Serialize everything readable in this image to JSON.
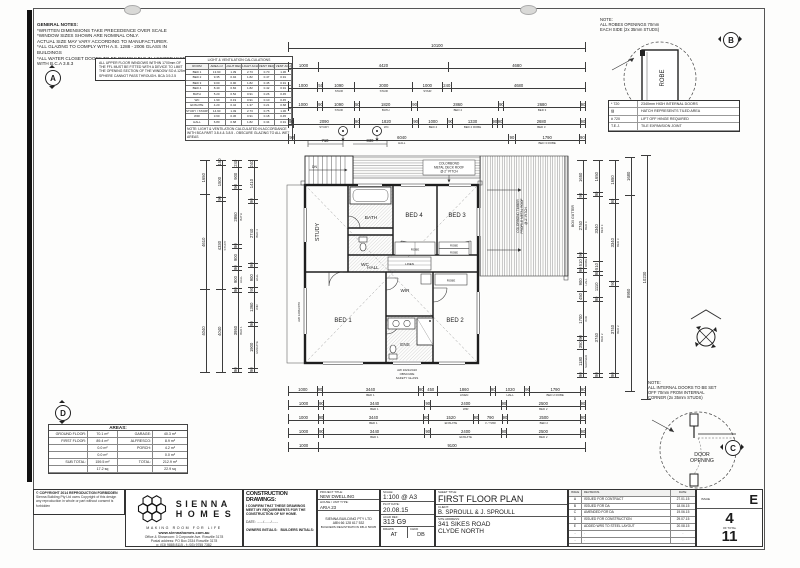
{
  "general_notes": {
    "title": "GENERAL NOTES:",
    "lines": [
      "*WRITTEN DIMENSIONS TAKE PRECEDENCE OVER SCALE",
      "*WINDOW SIZES SHOWN ARE NOMINAL ONLY.",
      "ACTUAL SIZE MAY VARY ACCORDING TO MANUFACTURER.",
      "*ALL GLAZING TO COMPLY WITH A.S. 1288 - 2006 GLASS IN",
      "BUILDINGS",
      "*ALL WATER CLOSET DOORS TO BE REMOVABLE IN ACCORDANCE",
      "WITH B.C.A 3.8.3"
    ]
  },
  "note_a": {
    "letter": "A",
    "lines": [
      "ALL UPPER FLOOR WINDOWS WITHIN 1700mm OF",
      "THE FFL MUST BE FITTED WITH A DEVICE TO LIMIT",
      "THE OPENING SECTION OF THE WINDOW SO A 125mm",
      "SPHERE CANNOT PASS THROUGH- BCA 3.9.2.5"
    ]
  },
  "note_b": {
    "letter": "B",
    "lines": [
      "NOTE:",
      "ALL ROBES OPENINGS 70mm",
      "EACH SIDE (2x 35mm STUDS)"
    ],
    "robe": "ROBE"
  },
  "note_c": {
    "letter": "C",
    "lines": [
      "NOTE:",
      "ALL INTERNAL DOORS TO BE SET",
      "OFF 70mm FROM INTERNAL",
      "CORNER (2x 35mm STUDS)"
    ],
    "label1": "DOOR",
    "label2": "OPENING"
  },
  "marker_d": "D",
  "legend": {
    "rows": [
      {
        "k": "* 720",
        "d": "2340mm HIGH INTERNAL DOORS"
      },
      {
        "k": "▨",
        "d": "HATCH REPRESENTS TILED AREA"
      },
      {
        "k": "# 720",
        "d": "LIFT OFF HINGE REQUIRED"
      },
      {
        "k": "T.E.J.",
        "d": "TILE EXPANSION JOINT"
      }
    ]
  },
  "vent_table": {
    "title": "LIGHT & VENTILATION CALCULATIONS",
    "headers": {
      "c0": "ROOM",
      "c1": "AREA m²",
      "c2": "LIGHT REQ",
      "c3": "LIGHT ACH",
      "c4": "VENT REQ",
      "c5": "VENT ACH"
    },
    "rows": [
      {
        "c0": "BED 1",
        "c1": "13.90",
        "c2": "1.39",
        "c3": "2.73",
        "c4": "0.70",
        "c5": "1.36"
      },
      {
        "c0": "BED 2",
        "c1": "9.35",
        "c2": "0.94",
        "c3": "1.82",
        "c4": "0.47",
        "c5": "0.91"
      },
      {
        "c0": "BED 3",
        "c1": "9.00",
        "c2": "0.90",
        "c3": "1.82",
        "c4": "0.45",
        "c5": "0.91"
      },
      {
        "c0": "BED 4",
        "c1": "8.40",
        "c2": "0.84",
        "c3": "1.82",
        "c4": "0.42",
        "c5": "0.91"
      },
      {
        "c0": "BATH",
        "c1": "5.20",
        "c2": "0.52",
        "c3": "0.91",
        "c4": "0.26",
        "c5": "0.45"
      },
      {
        "c0": "WC",
        "c1": "1.90",
        "c2": "0.19",
        "c3": "0.91",
        "c4": "0.10",
        "c5": "0.45"
      },
      {
        "c0": "ENSUITE",
        "c1": "4.20",
        "c2": "0.42",
        "c3": "1.37",
        "c4": "0.21",
        "c5": "0.68"
      },
      {
        "c0": "STUDY / STAIRS",
        "c1": "14.90",
        "c2": "1.49",
        "c3": "2.73",
        "c4": "0.75",
        "c5": "1.36"
      },
      {
        "c0": "WIR",
        "c1": "3.60",
        "c2": "0.36",
        "c3": "0.91",
        "c4": "0.18",
        "c5": "0.45"
      },
      {
        "c0": "HALL",
        "c1": "6.80",
        "c2": "0.68",
        "c3": "1.82",
        "c4": "0.34",
        "c5": "0.91"
      }
    ],
    "note": "NOTE: LIGHT & VENTILATION CALCULATED IN ACCORDANCE WITH BCA PART 3.8.4 & 3.8.5 - OBSCURE GLAZING TO ALL WET AREAS"
  },
  "areas": {
    "title": "AREAS:",
    "rows": [
      {
        "l": "GROUND FLOOR:",
        "lv": "70.1 m²",
        "r": "GARAGE:",
        "rv": "40.3 m²"
      },
      {
        "l": "FIRST FLOOR:",
        "lv": "89.4 m²",
        "r": "ALFRESCO:",
        "rv": "8.9 m²"
      },
      {
        "l": "",
        "lv": "0.0 m²",
        "r": "PORCH:",
        "rv": "4.2 m²"
      },
      {
        "l": "",
        "lv": "0.0 m²",
        "r": "",
        "rv": "0.0 m²"
      },
      {
        "l": "SUB TOTAL:",
        "lv": "159.5 m²",
        "r": "TOTAL:",
        "rv": "212.9 m²"
      },
      {
        "l": "",
        "lv": "17.2 sq",
        "r": "",
        "rv": "22.9 sq"
      }
    ]
  },
  "plan": {
    "study": "STUDY",
    "bath": "BATH",
    "wc": "WC",
    "bed4": "BED 4",
    "bed3": "BED 3",
    "hall": "HALL",
    "bed1": "BED 1",
    "wir": "WIR",
    "ens": "ENS",
    "bed2": "BED 2",
    "linen": "LINEN",
    "robe": "ROBE",
    "dn": "DN",
    "box_gutter": "BOX GUTTER",
    "alf1": "COLORBOND TIMBER",
    "alf2": "PROFILE METAL ROOF",
    "alf3": "@ 2° PITCH",
    "deck1": "COLORBOND",
    "deck2": "METAL DECK ROOF",
    "deck3": "@ 2° PITCH",
    "win_left": "AW 1206/2070",
    "win_ens1": "AW 1021/2410",
    "win_ens2": "OBSCURE",
    "win_ens3": "SAFETY GLASS",
    "mini1": "710",
    "mini2": "830"
  },
  "dims": {
    "t0": [
      {
        "t": "10100",
        "w": 10100
      }
    ],
    "t1": [
      {
        "t": "1000",
        "w": 1000
      },
      {
        "t": "4420",
        "w": 4420
      },
      {
        "t": "4680",
        "w": 4680
      }
    ],
    "t2": [
      {
        "t": "1000",
        "w": 1000
      },
      {
        "t": "50",
        "w": 140
      },
      {
        "t": "1090",
        "s": "STAIR",
        "w": 1090
      },
      {
        "t": "2000",
        "s": "STAIR",
        "w": 2000
      },
      {
        "t": "1000",
        "s": "STAIR",
        "w": 1000
      },
      {
        "t": "240",
        "w": 300
      },
      {
        "t": "4680",
        "w": 4680
      }
    ],
    "t3": [
      {
        "t": "1000",
        "w": 1000
      },
      {
        "t": "90",
        "w": 150
      },
      {
        "t": "1090",
        "s": "STAIR",
        "w": 1090
      },
      {
        "t": "50",
        "w": 140
      },
      {
        "t": "1820",
        "s": "BATH",
        "w": 1820
      },
      {
        "t": "90",
        "w": 150
      },
      {
        "t": "2860",
        "s": "BED 4",
        "w": 2860
      },
      {
        "t": "90",
        "w": 150
      },
      {
        "t": "2680",
        "s": "BED 3",
        "w": 2680
      },
      {
        "t": "90",
        "w": 150
      }
    ],
    "t4": [
      {
        "t": "90",
        "w": 150
      },
      {
        "t": "2090",
        "s": "STUDY",
        "w": 2090
      },
      {
        "t": "90",
        "w": 150
      },
      {
        "t": "1820",
        "s": "WC",
        "w": 1820
      },
      {
        "t": "90",
        "w": 150
      },
      {
        "t": "1000",
        "s": "BED 4",
        "w": 1000
      },
      {
        "t": "90",
        "w": 150
      },
      {
        "t": "1330",
        "s": "BED 4 ROBE",
        "w": 1330
      },
      {
        "t": "90",
        "w": 150
      },
      {
        "t": "90",
        "w": 150
      },
      {
        "t": "2680",
        "s": "BED 3",
        "w": 2680
      },
      {
        "t": "90",
        "w": 150
      }
    ],
    "t5": [
      {
        "t": "90",
        "w": 150
      },
      {
        "t": "6040",
        "s": "HALL",
        "w": 6040
      },
      {
        "t": "90",
        "w": 150
      },
      {
        "t": "1790",
        "s": "BED 3 ROBE",
        "w": 1790
      },
      {
        "t": "90",
        "w": 150
      }
    ],
    "b0": [
      {
        "t": "1000",
        "w": 1000
      },
      {
        "t": "90",
        "w": 150
      },
      {
        "t": "3440",
        "s": "BED 1",
        "w": 3440
      },
      {
        "t": "90",
        "w": 150
      },
      {
        "t": "450",
        "w": 480
      },
      {
        "t": "1860",
        "s": "LINEN",
        "w": 1860
      },
      {
        "t": "90",
        "w": 150
      },
      {
        "t": "1020",
        "s": "HALL",
        "w": 1020
      },
      {
        "t": "90",
        "w": 150
      },
      {
        "t": "1790",
        "s": "BED 2 ROBE",
        "w": 1790
      },
      {
        "t": "90",
        "w": 150
      }
    ],
    "b1": [
      {
        "t": "1000",
        "w": 1000
      },
      {
        "t": "90",
        "w": 150
      },
      {
        "t": "3440",
        "s": "BED 1",
        "w": 3440
      },
      {
        "t": "90",
        "w": 150
      },
      {
        "t": "2400",
        "s": "WIR",
        "w": 2400
      },
      {
        "t": "90",
        "w": 150
      },
      {
        "t": "2500",
        "s": "BED 2",
        "w": 2500
      },
      {
        "t": "90",
        "w": 150
      }
    ],
    "b2": [
      {
        "t": "1000",
        "w": 1000
      },
      {
        "t": "90",
        "w": 150
      },
      {
        "t": "3440",
        "s": "BED 1",
        "w": 3440
      },
      {
        "t": "90",
        "w": 150
      },
      {
        "t": "1520",
        "s": "ENSUITE",
        "w": 1520
      },
      {
        "t": "90",
        "w": 150
      },
      {
        "t": "790",
        "s": "V / TWR",
        "w": 790
      },
      {
        "t": "90",
        "w": 150
      },
      {
        "t": "2500",
        "s": "BED 2",
        "w": 2500
      },
      {
        "t": "90",
        "w": 150
      }
    ],
    "b3": [
      {
        "t": "1000",
        "w": 1000
      },
      {
        "t": "90",
        "w": 150
      },
      {
        "t": "3440",
        "s": "BED 1",
        "w": 3440
      },
      {
        "t": "90",
        "w": 150
      },
      {
        "t": "2400",
        "s": "ENSUITE",
        "w": 2400
      },
      {
        "t": "90",
        "w": 150
      },
      {
        "t": "2500",
        "s": "BED 2",
        "w": 2500
      },
      {
        "t": "90",
        "w": 150
      }
    ],
    "b4": [
      {
        "t": "1000",
        "w": 1000
      },
      {
        "t": "9100",
        "w": 9100
      }
    ],
    "l0": [
      {
        "t": "4040",
        "w": 4040
      },
      {
        "t": "4610",
        "w": 4610
      },
      {
        "t": "1650",
        "w": 1650
      }
    ],
    "l1": [
      {
        "t": "4040",
        "w": 4040
      },
      {
        "t": "4330",
        "s": "STUDY",
        "w": 4330
      },
      {
        "t": "90",
        "w": 150
      },
      {
        "t": "1500",
        "w": 1500
      },
      {
        "t": "150",
        "w": 220
      }
    ],
    "l2": [
      {
        "t": "90",
        "w": 150
      },
      {
        "t": "3950",
        "s": "BED 1",
        "w": 3950
      },
      {
        "t": "90",
        "w": 150
      },
      {
        "t": "900",
        "s": "HALL",
        "w": 900
      },
      {
        "t": "90",
        "w": 150
      },
      {
        "t": "900",
        "w": 900
      },
      {
        "t": "90",
        "w": 150
      },
      {
        "t": "2860",
        "s": "BATH",
        "w": 2860
      },
      {
        "t": "90",
        "w": 150
      },
      {
        "t": "900",
        "w": 900
      },
      {
        "t": "240",
        "w": 300
      }
    ],
    "l3": [
      {
        "t": "90",
        "w": 150
      },
      {
        "t": "1900",
        "s": "ENSUITE",
        "w": 1900
      },
      {
        "t": "90",
        "w": 150
      },
      {
        "t": "1360",
        "s": "WIR",
        "w": 1360
      },
      {
        "t": "90",
        "w": 150
      },
      {
        "t": "900",
        "s": "HALL",
        "w": 900
      },
      {
        "t": "90",
        "w": 150
      },
      {
        "t": "2740",
        "s": "BED 4",
        "w": 2740
      },
      {
        "t": "90",
        "w": 150
      },
      {
        "t": "1410",
        "w": 1410
      },
      {
        "t": "240",
        "w": 300
      }
    ],
    "r0": [
      {
        "t": "90",
        "w": 150
      },
      {
        "t": "1180",
        "s": "SHOWER",
        "w": 1180
      },
      {
        "t": "350",
        "w": 400
      },
      {
        "t": "90",
        "w": 150
      },
      {
        "t": "1700",
        "s": "WIR",
        "w": 1700
      },
      {
        "t": "450",
        "w": 480
      },
      {
        "t": "900",
        "s": "HALL",
        "w": 900
      },
      {
        "t": "90",
        "w": 150
      },
      {
        "t": "510",
        "s": "ROBE",
        "w": 520
      },
      {
        "t": "90",
        "w": 150
      },
      {
        "t": "2740",
        "s": "BED 4",
        "w": 2740
      },
      {
        "t": "90",
        "w": 150
      },
      {
        "t": "1650",
        "w": 1650
      }
    ],
    "r1": [
      {
        "t": "90",
        "w": 150
      },
      {
        "t": "3740",
        "s": "BED 2",
        "w": 3740
      },
      {
        "t": "90",
        "w": 150
      },
      {
        "t": "1110",
        "w": 1110
      },
      {
        "t": "90",
        "w": 150
      },
      {
        "t": "510",
        "w": 520
      },
      {
        "t": "3340",
        "s": "BED 3",
        "w": 3340
      },
      {
        "t": "90",
        "w": 150
      },
      {
        "t": "1650",
        "w": 1650
      }
    ],
    "r2": [
      {
        "t": "90",
        "w": 150
      },
      {
        "t": "3740",
        "s": "BED 2",
        "w": 3740
      },
      {
        "t": "90",
        "w": 150
      },
      {
        "t": "3340",
        "s": "BED 3",
        "w": 3340
      },
      {
        "t": "90",
        "w": 150
      },
      {
        "t": "1650",
        "w": 1650
      }
    ],
    "r3": [
      {
        "t": "8950",
        "w": 8950
      },
      {
        "t": "1680",
        "w": 1680
      }
    ],
    "r4": [
      {
        "t": "10230",
        "w": 10230
      }
    ]
  },
  "copyright": {
    "line1": "© COPYRIGHT 2014 REPRODUCTION FORBIDDEN",
    "line2": "Sienna Building Pty Ltd owns Copyright of this design any reproduction in whole or part without consent is forbidden"
  },
  "logo": {
    "name1": "SIENNA",
    "name2": "HOMES",
    "tagline": "MAKING ROOM FOR LIFE",
    "web": "www.siennahomes.com.au",
    "addr1": "Office & Showroom: 3 Corporate Ave. Rowville  3178",
    "addr2": "Postal address: PO Box 2334 Rowville 3178",
    "addr3": "p: (03) 9885 8115 - f: (03) 9755 7382"
  },
  "construction": {
    "title": "CONSTRUCTION DRAWINGS:",
    "statement": "I CONFIRM THAT THESE DRAWINGS MEET MY REQUIREMENTS FOR THE CONSTRUCTION OF MY HOME.",
    "date": "DATE: ......./......./.......",
    "owners": "OWNERS INITIALS:",
    "builders": "BUILDERS INITIALS:"
  },
  "project": {
    "l1": "PROJECT TITLE:",
    "v1": "NEW DWELLING",
    "l2": "HOUSE / UNIT TYPE:",
    "v2": "ARIA 23",
    "company": "SIENNA BUILDING PTY LTD",
    "abn": "ABN 66 128 617 532",
    "reg": "BUILDERS REGISTRATION DB-U 50635"
  },
  "meta": {
    "l_scale": "SCALE:",
    "scale": "1:100 @ A3",
    "l_plot": "PLOT DATE:",
    "plot": "20.08.15",
    "l_acad": "ACAD REF:",
    "acad": "313 G9",
    "l_drawn": "DRAWN",
    "drawn": "AT",
    "l_chkd": "CHKD",
    "chkd": "DB"
  },
  "sheet_info": {
    "l_title": "SHEET TITLE:",
    "title": "FIRST FLOOR PLAN",
    "l_client": "CLIENT:",
    "client": "B. SPROULL & J. SPROULL",
    "l_site": "SITE ADDRESS:",
    "site1": "341 SIKES ROAD",
    "site2": "CLYDE NORTH"
  },
  "revisions": {
    "h_issue": "ISSUE",
    "h_rev": "REVISIONS.",
    "h_date": "DATE:",
    "rows": [
      {
        "i": "A",
        "r": "ISSUED FOR CONTRACT",
        "d": "27.01.15"
      },
      {
        "i": "B",
        "r": "ISSUED FOR DA",
        "d": "18.06.15"
      },
      {
        "i": "C",
        "r": "AMENDED FOR DA",
        "d": "19.06.15"
      },
      {
        "i": "D",
        "r": "ISSUED FOR CONSTRUCTION",
        "d": "29.07.15"
      },
      {
        "i": "E",
        "r": "ADDED WRS TO STEEL LAYOUT",
        "d": "20.08.15"
      },
      {
        "i": "-",
        "r": ".",
        "d": "."
      },
      {
        "i": "-",
        "r": ".",
        "d": "."
      }
    ]
  },
  "issue_box": {
    "label": "ISSUE",
    "value": "E",
    "sheet": "4",
    "of": "OF TOTAL",
    "total": "11"
  }
}
